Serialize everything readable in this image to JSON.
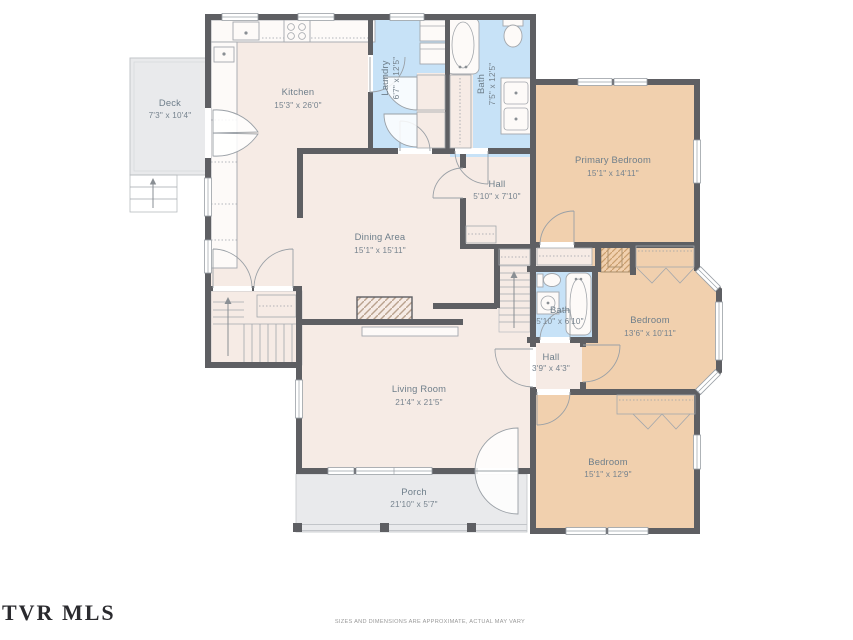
{
  "colors": {
    "wall": "#5e5f63",
    "floor_beige": "#f6ebe5",
    "bedroom_tan": "#f1d0ae",
    "wet_blue": "#c7e2f7",
    "outdoor_gray": "#e9eaec",
    "label_gray": "#6e7e8a"
  },
  "rooms": {
    "deck": {
      "name": "Deck",
      "dims": "7'3\" x 10'4\""
    },
    "kitchen": {
      "name": "Kitchen",
      "dims": "15'3\" x 26'0\""
    },
    "laundry": {
      "name": "Laundry",
      "dims": "6'7\" x 12'5\""
    },
    "bath_upper": {
      "name": "Bath",
      "dims": "7'5\" x 12'5\""
    },
    "primary_bedroom": {
      "name": "Primary Bedroom",
      "dims": "15'1\" x 14'11\""
    },
    "hall_upper": {
      "name": "Hall",
      "dims": "5'10\" x 7'10\""
    },
    "dining": {
      "name": "Dining Area",
      "dims": "15'1\" x 15'11\""
    },
    "bath_lower": {
      "name": "Bath",
      "dims": "5'10\" x 6'10\""
    },
    "bedroom_middle": {
      "name": "Bedroom",
      "dims": "13'6\" x 10'11\""
    },
    "hall_lower": {
      "name": "Hall",
      "dims": "3'9\" x 4'3\""
    },
    "living": {
      "name": "Living Room",
      "dims": "21'4\" x 21'5\""
    },
    "bedroom_bottom": {
      "name": "Bedroom",
      "dims": "15'1\" x 12'9\""
    },
    "porch": {
      "name": "Porch",
      "dims": "21'10\" x 5'7\""
    }
  },
  "footer": {
    "logo": "TVR MLS",
    "disclaimer": "SIZES AND DIMENSIONS ARE APPROXIMATE, ACTUAL MAY VARY"
  }
}
